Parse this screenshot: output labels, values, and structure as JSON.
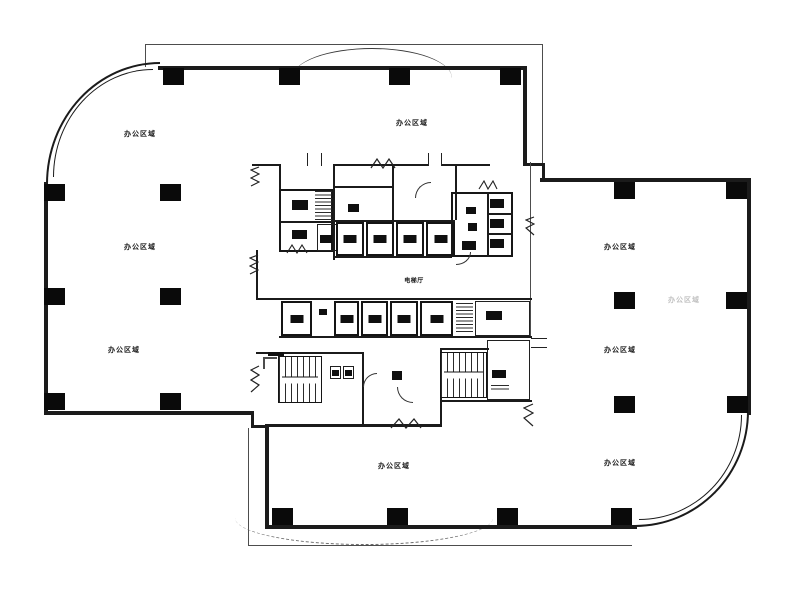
{
  "canvas": {
    "width_px": 800,
    "height_px": 590,
    "paper_color": "#ffffff",
    "ink_color": "#1b1b1b",
    "column_color": "#0a0a0a"
  },
  "labels": {
    "office_area": "办公区域",
    "elevator_hall": "电梯厅"
  },
  "label_instances": {
    "office_area_positions": [
      "wing-a-upper-left",
      "wing-a-top-center",
      "wing-a-middle-left",
      "wing-a-lower-left",
      "wing-b-upper-right",
      "wing-b-middle-right",
      "wing-b-lower-right",
      "wing-b-bottom-center",
      "wing-b-right-faint"
    ],
    "elevator_hall_positions": [
      "core-center"
    ]
  }
}
